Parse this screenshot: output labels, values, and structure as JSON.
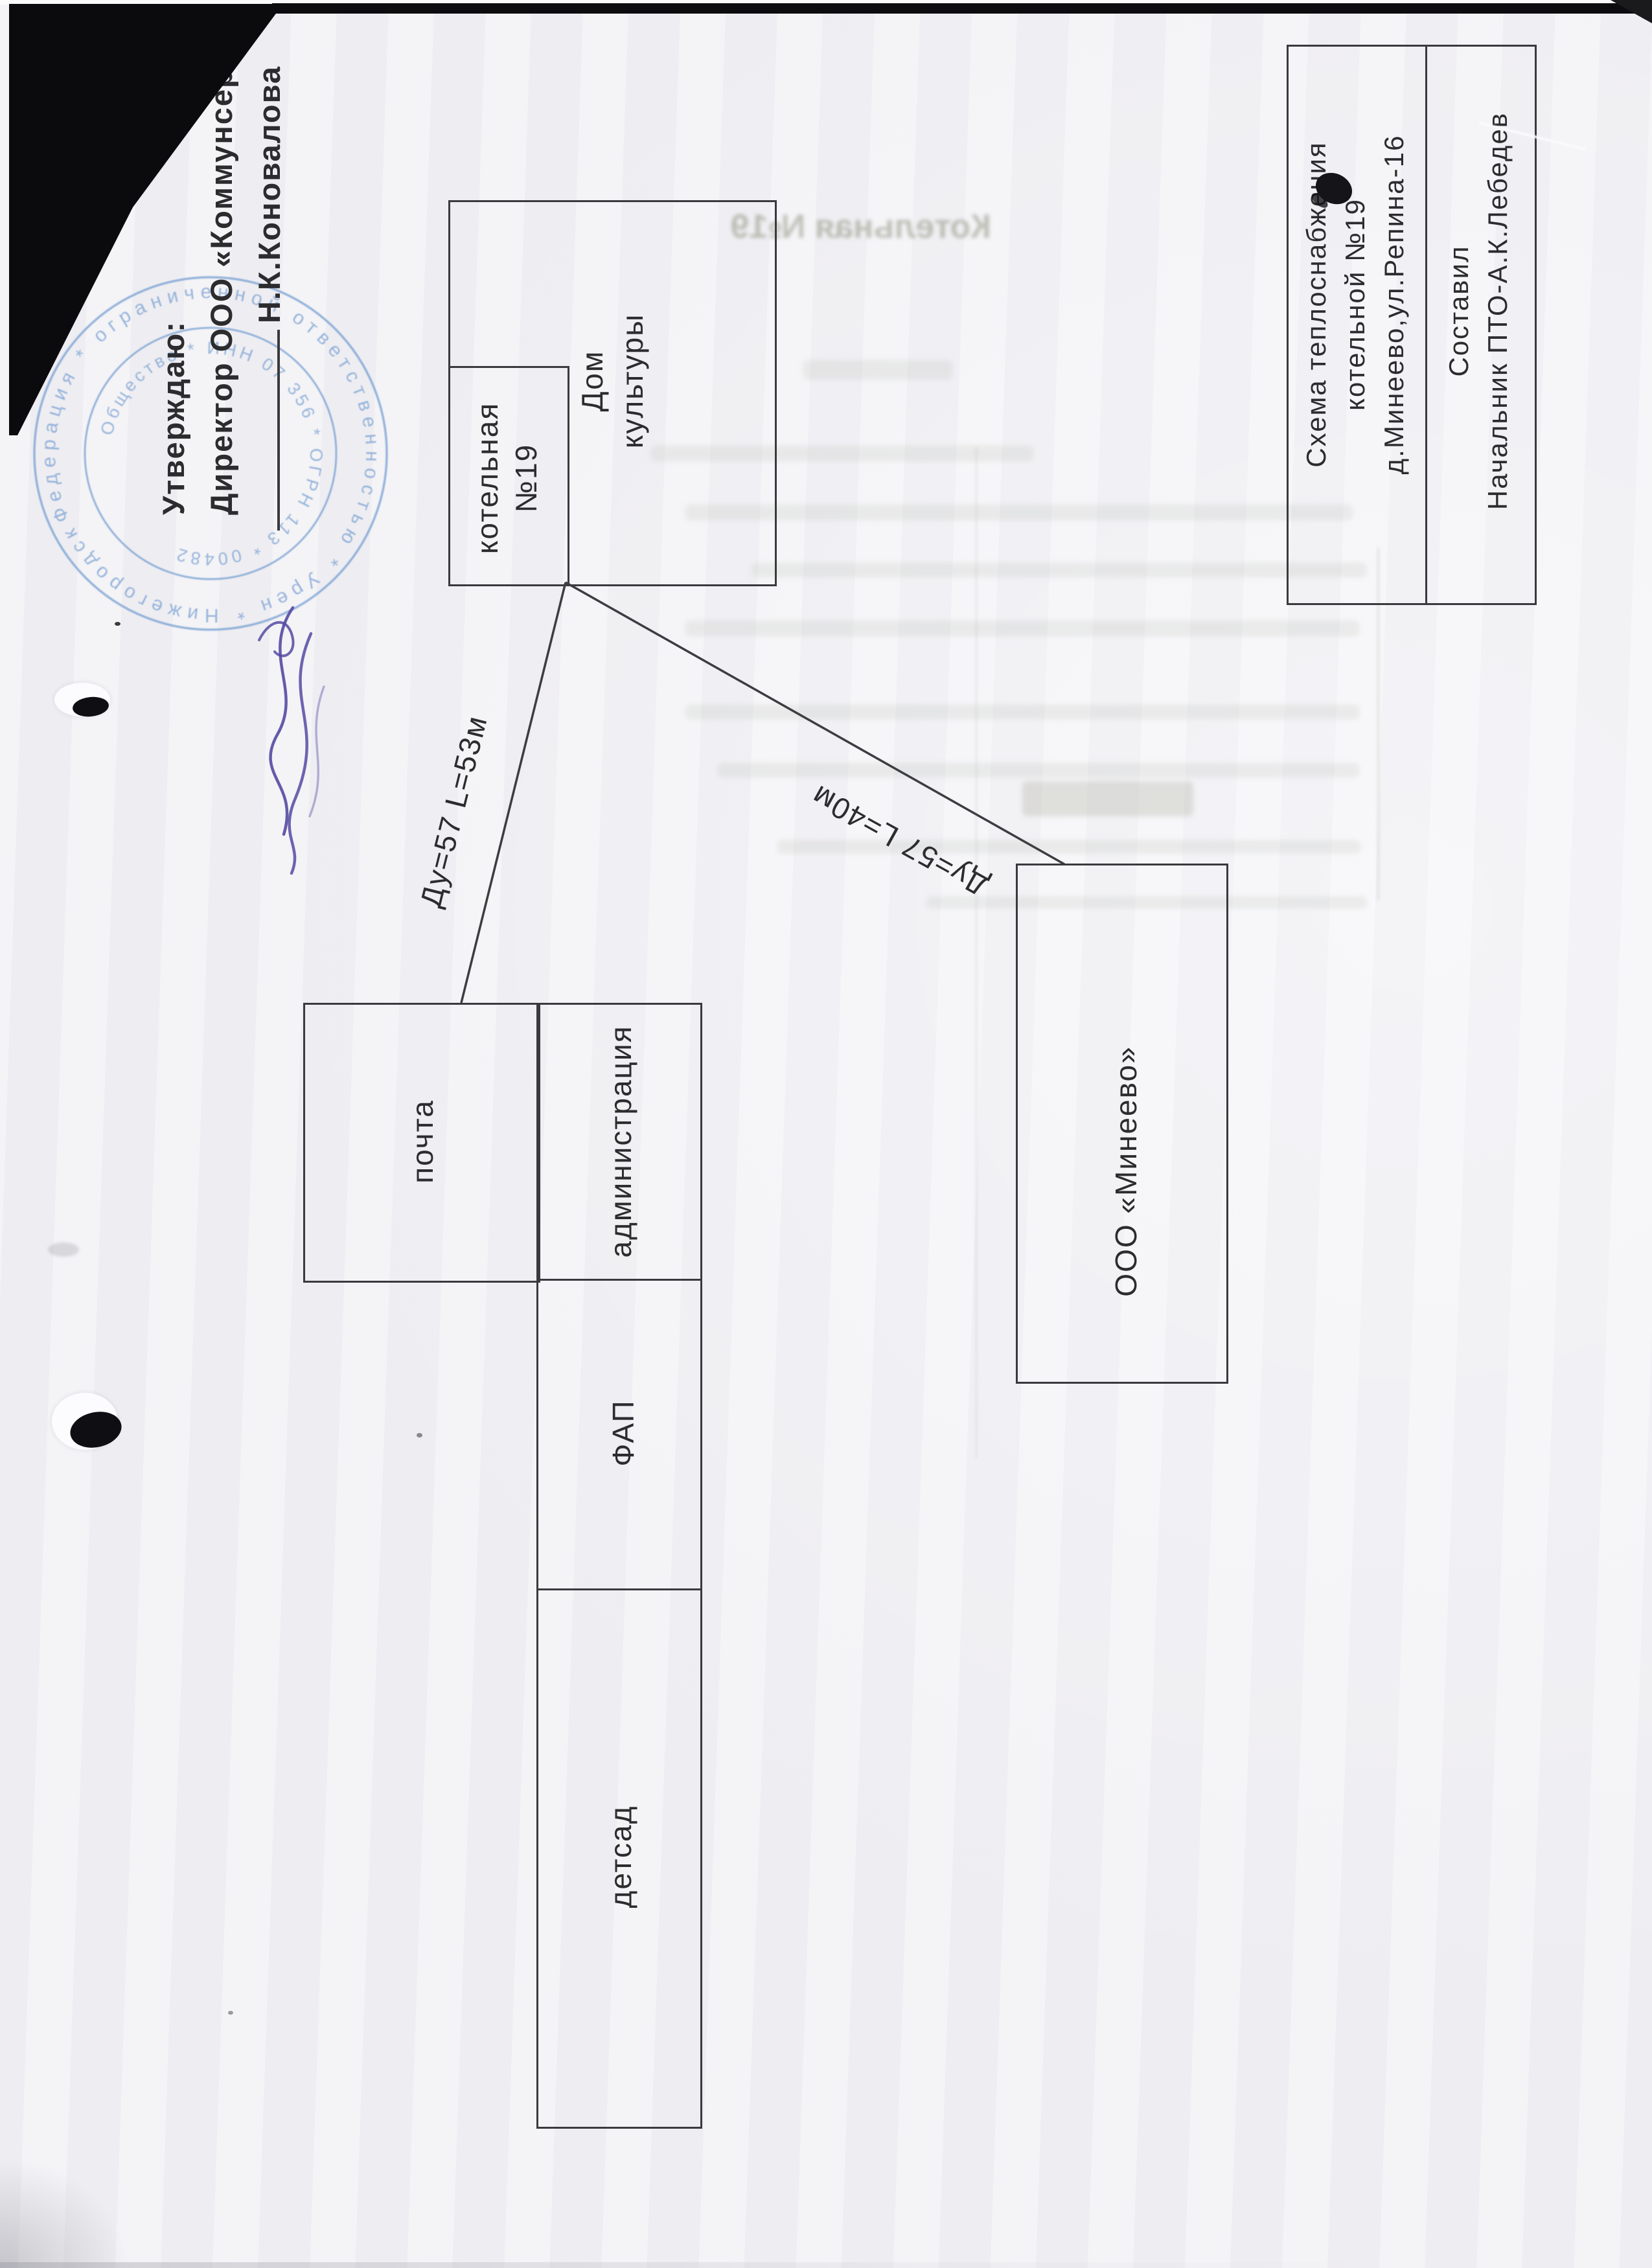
{
  "approval": {
    "line1": "Утверждаю:",
    "line2": "Директор ООО «Коммунсервис»",
    "name": "Н.К.Коновалова"
  },
  "stamp": {
    "ring_outer_text": "Федерация  *  ограниченной ответственностью  *  Урен  *  Нижегородская область",
    "ring_inner_text": "Общество  *  ИНН 07 356  *  ОГРН 113  *  00482",
    "color": "#5e90cc"
  },
  "title_block": {
    "scheme_lines": [
      "Схема теплоснабжения",
      "котельной №19",
      "д.Минеево,ул.Репина-16"
    ],
    "author_lines": [
      "Составил",
      "Начальник ПТО-А.К.Лебедев"
    ]
  },
  "buildings": {
    "dom_kultury": {
      "lines": [
        "Дом",
        "культуры"
      ]
    },
    "kotelnaya": {
      "lines": [
        "котельная",
        "№19"
      ]
    },
    "pochta": {
      "label": "почта"
    },
    "administration": {
      "label": "администрация"
    },
    "fap": {
      "label": "ФАП"
    },
    "detsad": {
      "label": "детсад"
    },
    "mineevo": {
      "label": "ООО «Минеево»"
    }
  },
  "pipes": {
    "to_pochta": {
      "label": "Ду=57 L=53м"
    },
    "to_mineevo": {
      "label": "Ду=57 L=40м"
    }
  },
  "bleedthrough": {
    "title": "Котельная №19"
  },
  "colors": {
    "ink": "#2c2c2e",
    "stamp_blue": "#5e90cc",
    "signature_purple": "#544aa2",
    "paper": "#f1f0f4"
  }
}
